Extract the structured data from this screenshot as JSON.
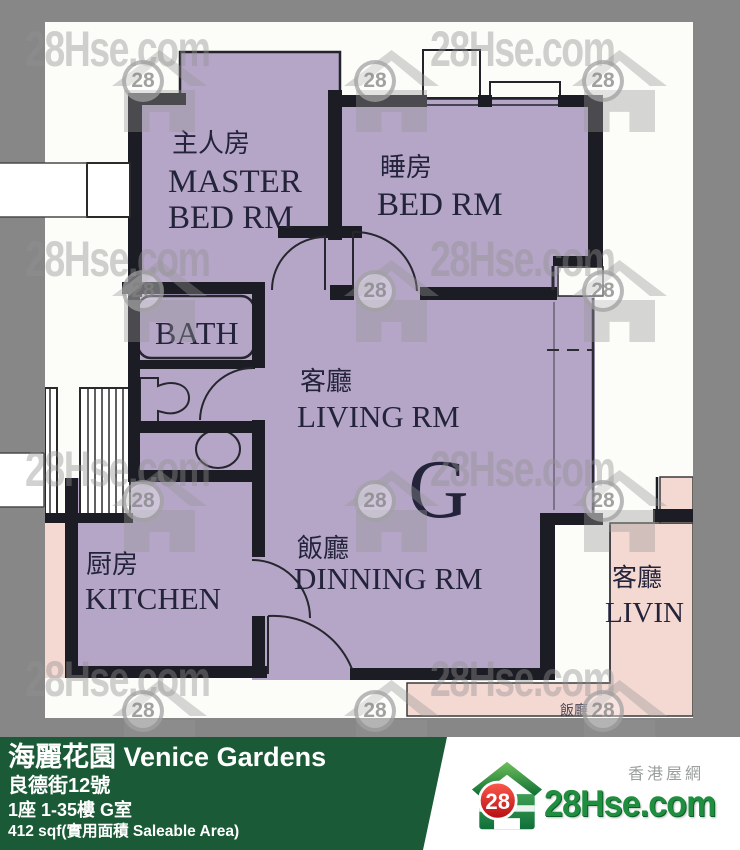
{
  "watermark": {
    "text": "28Hse.com",
    "badge": "28"
  },
  "floor_plan": {
    "unit_letter": "G",
    "rooms": {
      "master_zh": "主人房",
      "master_en_line1": "MASTER",
      "master_en_line2": "BED RM",
      "bedroom_zh": "睡房",
      "bedroom_en": "BED RM",
      "bath_en": "BATH",
      "living_zh": "客廳",
      "living_en": "LIVING RM",
      "dining_zh": "飯廳",
      "dining_en": "DINNING RM",
      "kitchen_zh": "厨房",
      "kitchen_en": "KITCHEN",
      "adjacent_living_zh": "客廳",
      "adjacent_living_en": "LIVIN",
      "adjacent_dining_zh": "飯廳"
    }
  },
  "footer": {
    "title": "海麗花園 Venice Gardens",
    "address": "良德街12號",
    "block_floor": "1座 1-35樓 G室",
    "area": "412 sqf(實用面積 Saleable Area)"
  },
  "logo": {
    "badge": "28",
    "site": "28Hse.com",
    "tagline": "香港屋網"
  },
  "colors": {
    "unit_fill": "#b5a6c8",
    "adjacent_fill": "#f4d8d2",
    "wall": "#1c1c24",
    "plan_background": "#fcfcf9",
    "frame": "#878787",
    "footer_green": "#1a5a36",
    "logo_green": "#1f8e3f",
    "logo_red": "#d8191f",
    "watermark_gray": "#9a9a9a"
  }
}
